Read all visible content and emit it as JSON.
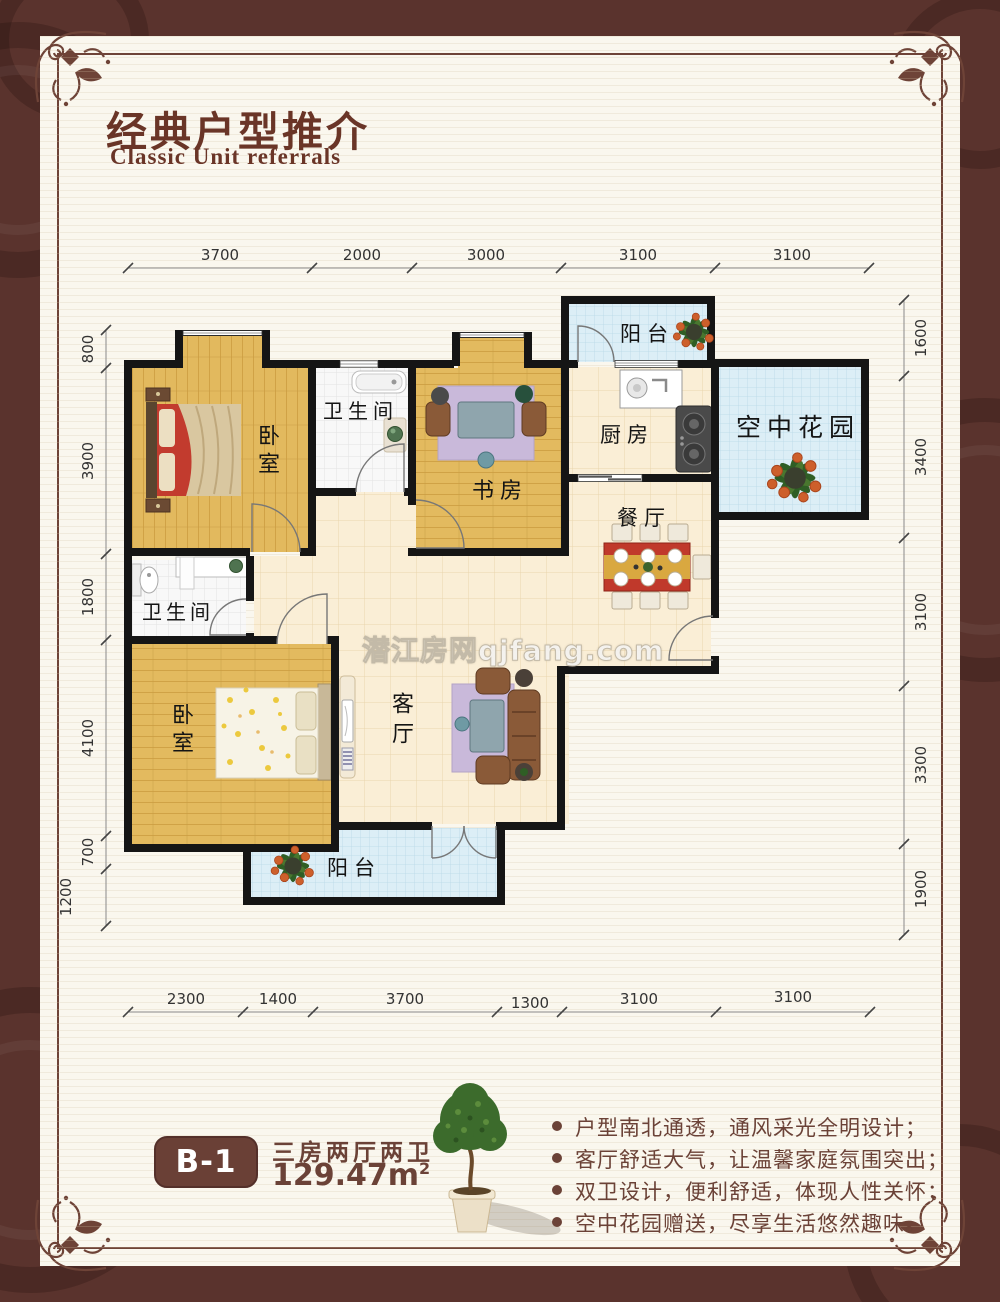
{
  "page": {
    "title_zh": "经典户型推介",
    "title_en": "Classic Unit referrals",
    "watermark": "潜江房网qjfang.com"
  },
  "rooms": {
    "bedroom1": "卧室",
    "bath1": "卫生间",
    "study": "书房",
    "balcony_top": "阳台",
    "kitchen": "厨房",
    "sky_garden": "空中花园",
    "dining": "餐厅",
    "living": "客厅",
    "bath2": "卫生间",
    "bedroom2": "卧室",
    "balcony_bottom": "阳台"
  },
  "dimensions": {
    "top": [
      "3700",
      "2000",
      "3000",
      "3100",
      "3100"
    ],
    "bottom": [
      "2300",
      "1400",
      "3700",
      "1300",
      "3100",
      "3100"
    ],
    "left": [
      "800",
      "3900",
      "1800",
      "4100",
      "700",
      "1200"
    ],
    "right": [
      "1600",
      "3400",
      "3100",
      "3300",
      "1900"
    ]
  },
  "footer": {
    "unit_code": "B-1",
    "unit_layout": "三房两厅两卫",
    "unit_area": "129.47m",
    "area_exponent": "2",
    "features": [
      "户型南北通透，通风采光全明设计；",
      "客厅舒适大气，让温馨家庭氛围突出；",
      "双卫设计，便利舒适，体现人性关怀；",
      "空中花园赠送，尽享生活悠然趣味。"
    ]
  },
  "colors": {
    "accent_brown": "#6e4337",
    "page_background": "#5a332d",
    "panel_cream": "#faf7ee",
    "wall_black": "#151515",
    "wood_floor": "#e3ba5f",
    "tile_blue": "#dceef6",
    "tile_cream": "#faeed6"
  }
}
